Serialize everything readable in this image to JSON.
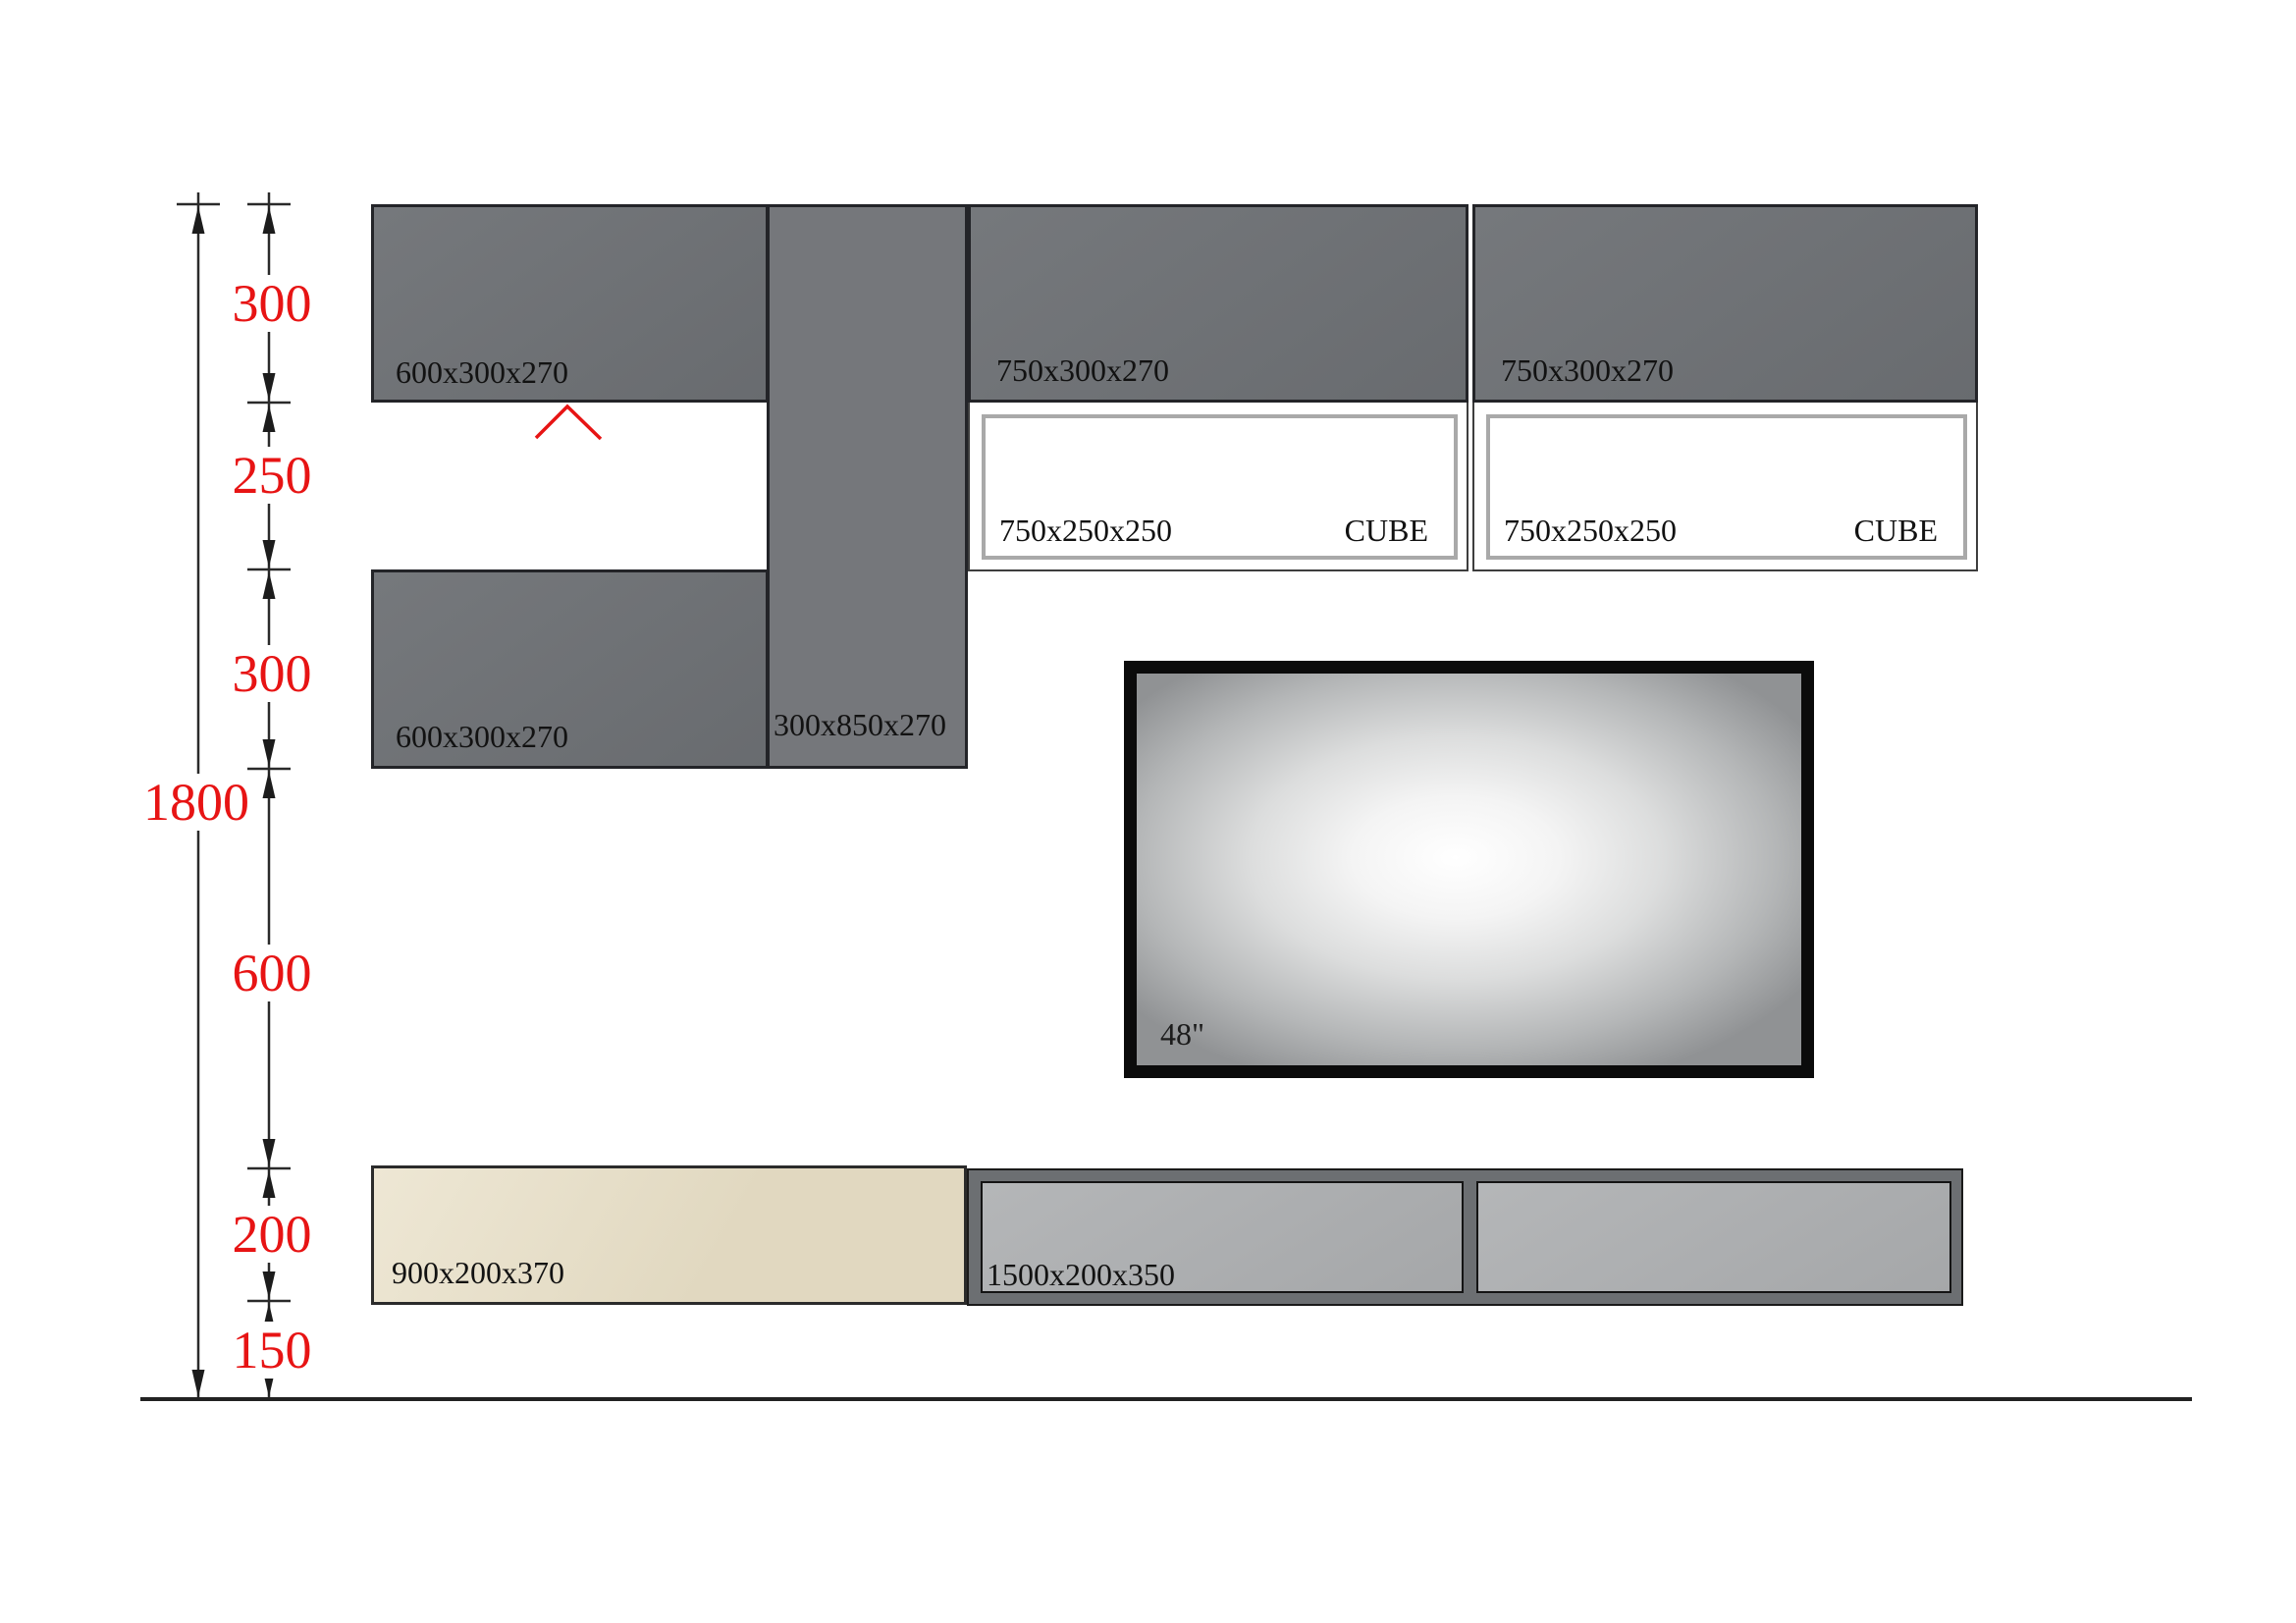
{
  "title": "Wall unit elevation drawing",
  "dim": {
    "total": "1800",
    "seg1": "300",
    "seg2": "250",
    "seg3": "300",
    "seg4": "600",
    "seg5": "200",
    "seg6": "150"
  },
  "cabinets": {
    "top_left": "600x300x270",
    "vertical": "300x850x270",
    "top_mid": "750x300x270",
    "top_right": "750x300x270",
    "bottom_left": "600x300x270",
    "cube_left_size": "750x250x250",
    "cube_left_tag": "CUBE",
    "cube_right_size": "750x250x250",
    "cube_right_tag": "CUBE",
    "shelf_beige": "900x200x370",
    "shelf_gray": "1500x200x350"
  },
  "tv": {
    "size_label": "48\""
  },
  "colors": {
    "cabinet_gray": "#6e7175",
    "cabinet_gray_light": "#75777b",
    "cube_border": "#a9a9a9",
    "beige": "#e8dfc6",
    "shelf_frame": "#6c6f72",
    "shelf_panel": "#aeb0b2",
    "dimension_red": "#e71414",
    "line_color": "#2a2a2a"
  }
}
